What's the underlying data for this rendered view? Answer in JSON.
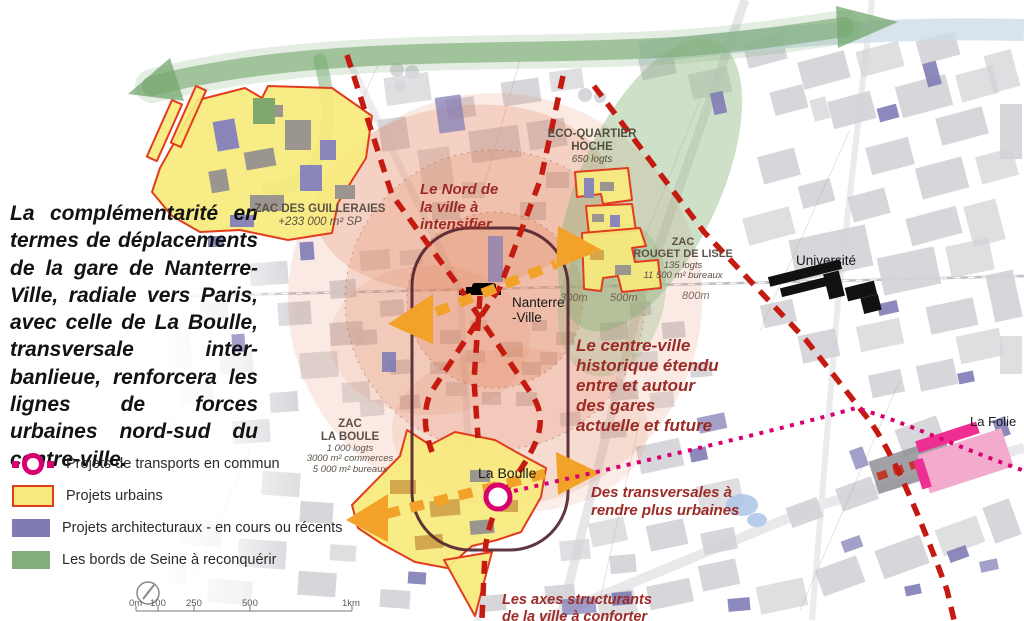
{
  "colors": {
    "transport_pink": "#d8006f",
    "urban_yellow": "#f7ea7d",
    "urban_border_red": "#e23c1e",
    "architectural_purple": "#7f7cb5",
    "seine_green": "#74a76d",
    "axis_dashed_red": "#c41a10",
    "arrow_orange": "#f2a229",
    "center_salmon": "#e07a52",
    "annotation_dark_red": "#9c2a26"
  },
  "intro": {
    "text": "La complémentarité en termes de déplacements de la gare de Nanterre-Ville, radiale vers Paris, avec celle de La Boulle, transversale inter-banlieue, renforcera les lignes de forces urbaines nord-sud du centre-ville."
  },
  "legend": {
    "items": [
      {
        "id": "transport",
        "label": "Projets de transports en commun"
      },
      {
        "id": "urban",
        "label": "Projets urbains"
      },
      {
        "id": "architectural",
        "label": "Projets architecturaux - en cours ou récents"
      },
      {
        "id": "seine",
        "label": "Les bords de Seine à reconquérir"
      }
    ]
  },
  "annotations": {
    "north": {
      "lines": [
        "Le Nord de",
        "la ville à",
        "intensifier"
      ]
    },
    "center": {
      "lines": [
        "Le centre-ville",
        "historique étendu",
        "entre et autour",
        "des gares",
        "actuelle et future"
      ]
    },
    "transversals": {
      "lines": [
        "Des transversales à",
        "rendre plus urbaines"
      ]
    },
    "axes": {
      "lines": [
        "Les axes structurants",
        "de la ville à conforter"
      ]
    }
  },
  "zones": {
    "guilleraies": {
      "name": "ZAC DES GUILLERAIES",
      "detail": "+233 000 m² SP"
    },
    "hoche": {
      "name1": "ECO-QUARTIER",
      "name2": "HOCHE",
      "detail": "650 logts"
    },
    "rouget": {
      "name1": "ZAC",
      "name2": "ROUGET DE LISLE",
      "detail1": "135 logts",
      "detail2": "11 500 m² bureaux"
    },
    "boule": {
      "name1": "ZAC",
      "name2": "LA BOULE",
      "detail1": "1 000 logts",
      "detail2": "3000 m² commerces",
      "detail3": "5 000 m² bureaux"
    }
  },
  "places": {
    "nanterre_line1": "Nanterre",
    "nanterre_line2": "-Ville",
    "la_boulle": "La Boulle",
    "la_folie": "La Folie",
    "universite": "Université"
  },
  "rings": {
    "r300": "300m",
    "r500": "500m",
    "r800": "800m"
  },
  "scale_bar": {
    "labels": [
      "0m",
      "100",
      "250",
      "500",
      "1km"
    ]
  }
}
